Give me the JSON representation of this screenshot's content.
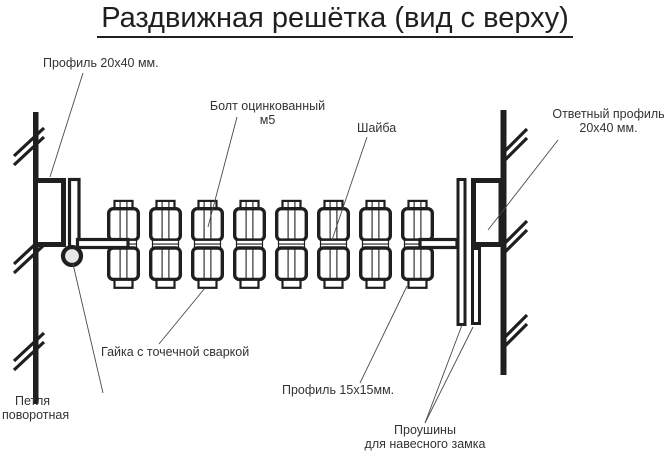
{
  "title": "Раздвижная решётка (вид с верху)",
  "labels": {
    "profile2040": "Профиль 20x40 мм.",
    "bolt_line1": "Болт оцинкованный",
    "bolt_line2": "м5",
    "washer": "Шайба",
    "counter_profile_line1": "Ответный профиль",
    "counter_profile_line2": "20x40 мм.",
    "nut": "Гайка с точечной сваркой",
    "profile1515": "Профиль 15x15мм.",
    "hinge_line1": "Петля",
    "hinge_line2": "поворотная",
    "lugs_line1": "Проушины",
    "lugs_line2": "для навесного замка"
  },
  "diagram": {
    "type": "technical-drawing",
    "view": "top view",
    "scissor_joint_count": 8,
    "colors": {
      "ink": "#1f1f1f",
      "leader": "#4a4a4a",
      "hinge_fill": "#e6e6e6",
      "background": "#ffffff"
    }
  }
}
